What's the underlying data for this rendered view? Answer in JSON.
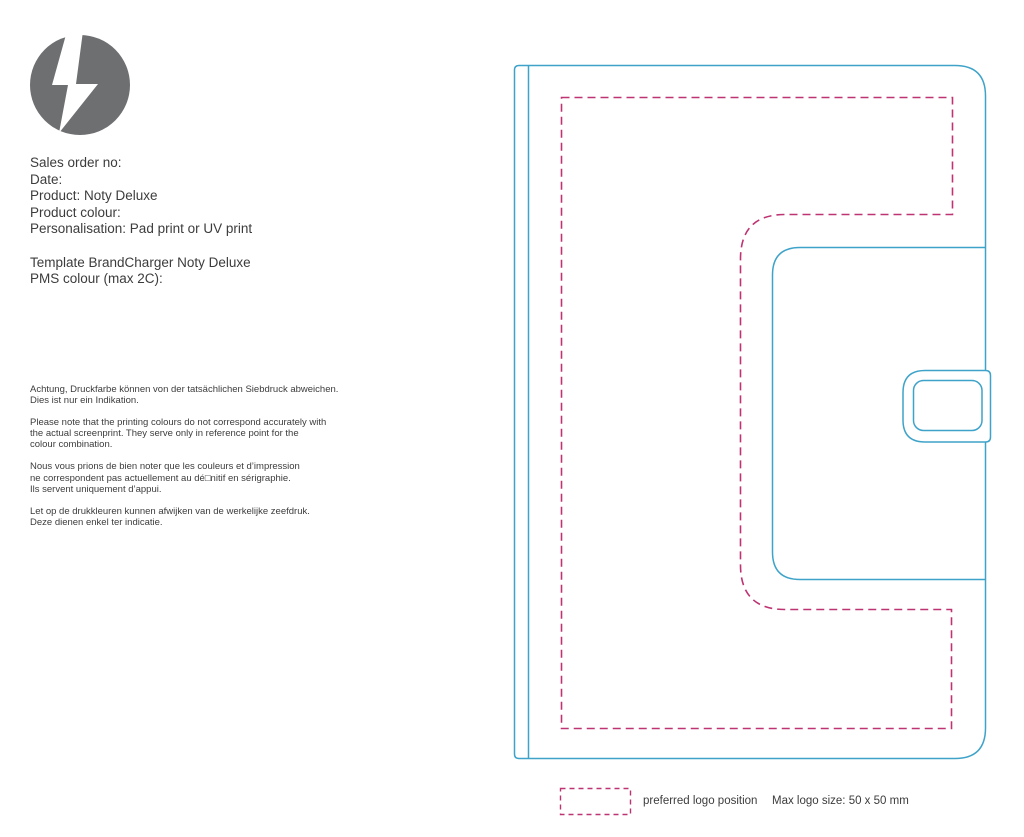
{
  "colors": {
    "drawing_line": "#3FA3C9",
    "dashed_line": "#BE3372",
    "logo_gray": "#6E6F71",
    "text": "#3C3C3C"
  },
  "order_info": {
    "block1": [
      "Sales order no:",
      "Date:",
      "Product: Noty Deluxe",
      "Product colour:",
      "Personalisation: Pad print or UV print"
    ],
    "block2": [
      "Template BrandCharger Noty Deluxe",
      "PMS colour (max 2C):"
    ]
  },
  "disclaimer": {
    "de": [
      "Achtung, Druckfarbe können von der tatsächlichen Siebdruck abweichen.",
      "Dies ist nur ein Indikation."
    ],
    "en": [
      "Please note that the printing colours do not correspond accurately with",
      "the actual screenprint. They serve only in reference point for the",
      "colour combination."
    ],
    "fr": [
      "Nous vous prions de bien noter que les couleurs et d’impression",
      "ne correspondent pas actuellement au dé□nitif en sérigraphie.",
      "Ils servent uniquement d’appui."
    ],
    "nl": [
      "Let op de drukkleuren kunnen afwijken van de werkelijke zeefdruk.",
      "Deze dienen enkel ter indicatie."
    ]
  },
  "legend": {
    "preferred_label": "preferred logo position",
    "max_size": "Max logo size: 50 x 50 mm"
  },
  "drawing": {
    "product": "Noty Deluxe notebook cover outline",
    "dashed_area_meaning": "preferred logo position"
  }
}
